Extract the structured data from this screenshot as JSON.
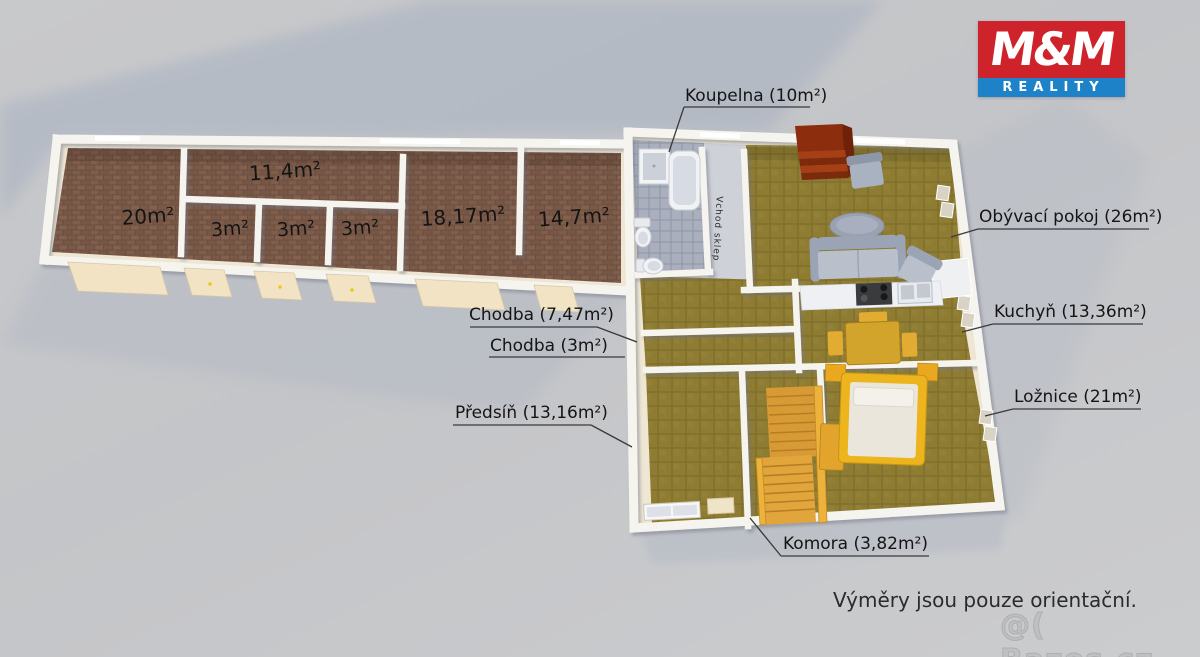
{
  "logo": {
    "top": "M&M",
    "bottom": "REALITY"
  },
  "callouts": {
    "koupelna": "Koupelna (10m²)",
    "chodba_747": "Chodba (7,47m²)",
    "chodba_3": "Chodba (3m²)",
    "predsin": "Předsíň (13,16m²)",
    "obyvaci_pokoj": "Obývací pokoj (26m²)",
    "kuchyn": "Kuchyň (13,36m²)",
    "loznice": "Ložnice (21m²)",
    "komora": "Komora (3,82m²)"
  },
  "floor_labels": {
    "room_20": "20m²",
    "corridor_11_4": "11,4m²",
    "cell_1": "3m²",
    "cell_2": "3m²",
    "cell_3": "3m²",
    "room_18_17": "18,17m²",
    "room_14_7": "14,7m²",
    "vchod_sklep": "Vchod sklep"
  },
  "footer": {
    "disclaimer": "Výměry jsou pouze orientační.",
    "watermark": "@( Bazos.cz"
  },
  "colors": {
    "brand_red": "#cf232b",
    "brand_blue": "#1e82c8",
    "floor_brick": "#7d5c4a",
    "floor_olive": "#8e7c32",
    "floor_tile": "#a9afbc",
    "wall": "#f6f4ee",
    "stairs_wood": "#e8a93e",
    "cellar_stairs_red": "#952f0e"
  }
}
